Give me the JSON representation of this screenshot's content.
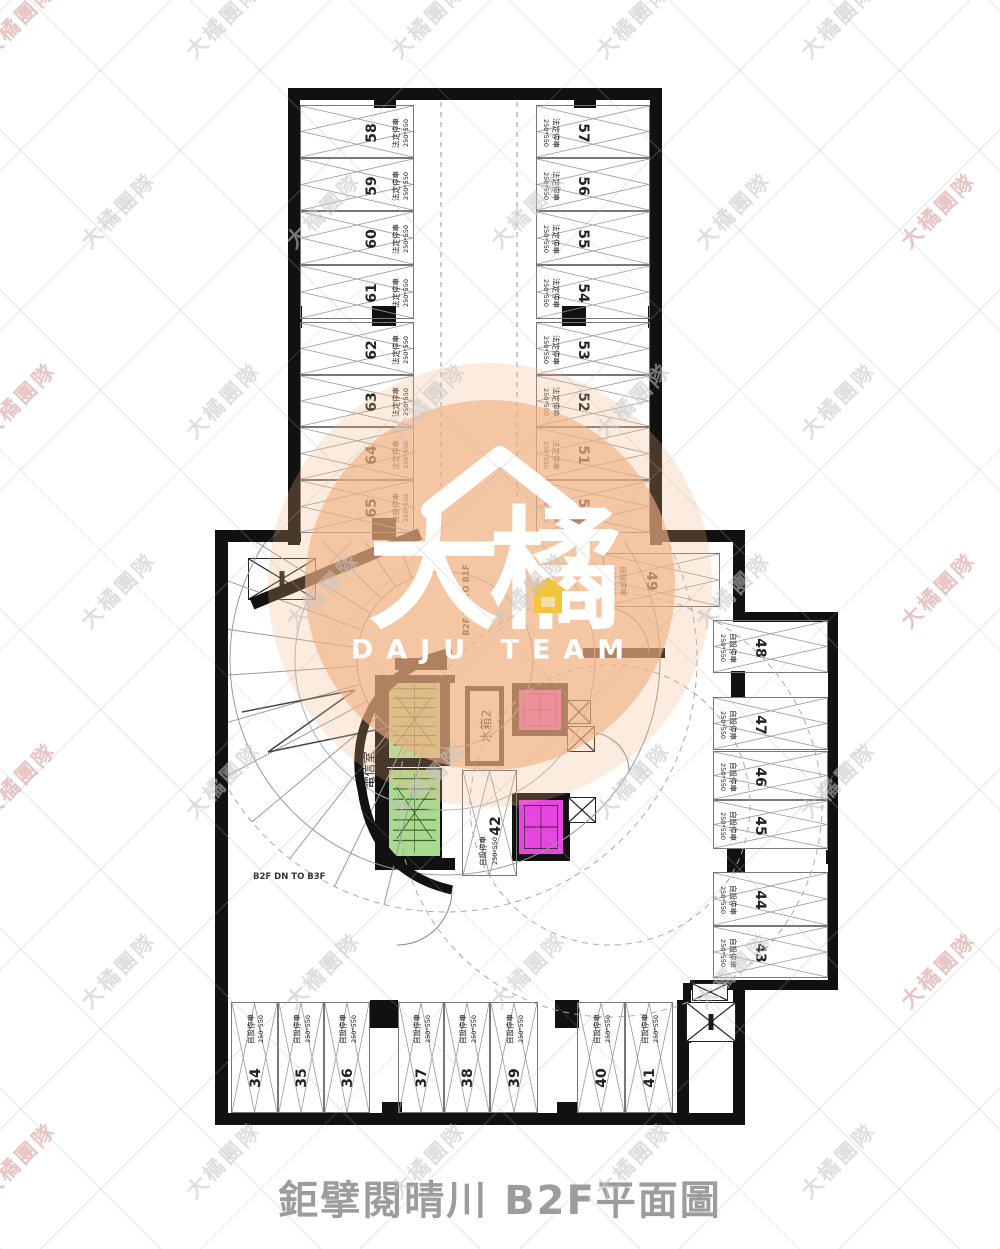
{
  "title": "鉅擘閱晴川 B2F平面圖",
  "watermark": {
    "text": "大橘團隊",
    "color_edge": "#d89494",
    "color_inner": "#c6c6c6"
  },
  "logo": {
    "line1": "大橘",
    "line2": "DAJU TEAM",
    "circle_color": "#f1af80",
    "house_color": "#f2c43c",
    "text_color": "#ffffff"
  },
  "ramp": {
    "up_label": "B2F UP TO B1F",
    "down_label": "B2F DN TO B3F"
  },
  "rooms": {
    "telecom": "電信室",
    "water_tank": "水箱2"
  },
  "stall_size": "250*550",
  "stall_types": {
    "legal": "法定停車",
    "self": "自設停車"
  },
  "colors": {
    "stair_green": "#b2e09a",
    "elevator_magenta": "#e645e0",
    "wall_black": "#111111"
  },
  "stalls": {
    "top_left_column": [
      {
        "num": "58",
        "type": "法定停車"
      },
      {
        "num": "59",
        "type": "法定停車"
      },
      {
        "num": "60",
        "type": "法定停車"
      },
      {
        "num": "61",
        "type": "法定停車"
      },
      {
        "num": "62",
        "type": "法定停車"
      },
      {
        "num": "63",
        "type": "法定停車"
      },
      {
        "num": "64",
        "type": "法定停車"
      },
      {
        "num": "65",
        "type": "自設停車"
      }
    ],
    "top_right_column": [
      {
        "num": "57",
        "type": "法定停車"
      },
      {
        "num": "56",
        "type": "法定停車"
      },
      {
        "num": "55",
        "type": "法定停車"
      },
      {
        "num": "54",
        "type": "法定停車"
      },
      {
        "num": "53",
        "type": "法定停車"
      },
      {
        "num": "52",
        "type": "法定停車"
      },
      {
        "num": "51",
        "type": "法定停車"
      },
      {
        "num": "50",
        "type": "自設停車"
      }
    ],
    "stall_49": {
      "num": "49",
      "type": "自設停車"
    },
    "right_column": [
      {
        "num": "48",
        "type": "自設停車"
      },
      {
        "num": "47",
        "type": "自設停車"
      },
      {
        "num": "46",
        "type": "自設停車"
      },
      {
        "num": "45",
        "type": "自設停車"
      },
      {
        "num": "44",
        "type": "自設停車"
      },
      {
        "num": "43",
        "type": "自設停車"
      }
    ],
    "bottom_row": [
      {
        "num": "34",
        "type": "自設停車"
      },
      {
        "num": "35",
        "type": "自設停車"
      },
      {
        "num": "36",
        "type": "自設停車"
      },
      {
        "num": "37",
        "type": "自設停車"
      },
      {
        "num": "38",
        "type": "自設停車"
      },
      {
        "num": "39",
        "type": "自設停車"
      },
      {
        "num": "40",
        "type": "自設停車"
      },
      {
        "num": "41",
        "type": "自設停車"
      }
    ],
    "stall_42": {
      "num": "42",
      "type": "自設停車"
    }
  }
}
